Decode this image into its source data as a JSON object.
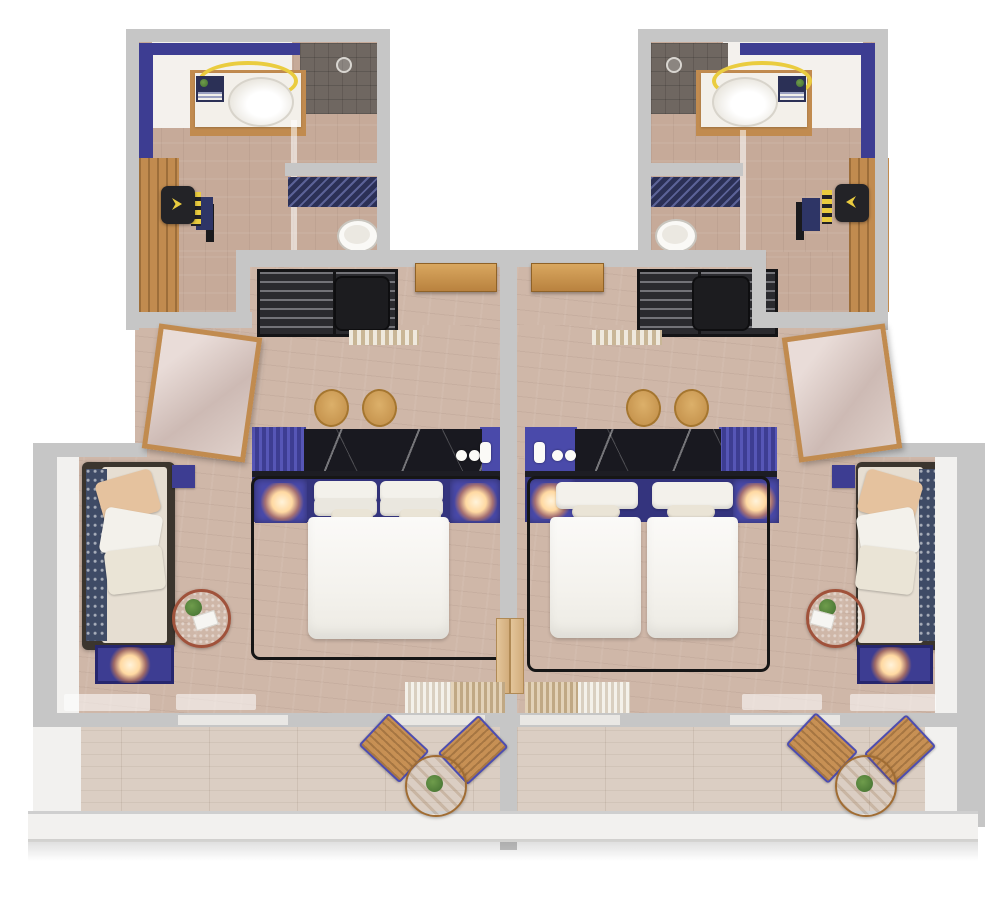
{
  "meta": {
    "kind": "3d-top-down-floor-plan-render",
    "description": "Isometric top-down 3D render of two adjoining hotel guest rooms sharing a central party wall. Each room has an en-suite bathroom with walk-in shower, vanity sink and toilet, a wardrobe and desk nook, an entry with slatted luggage racks, a bedroom with an indigo dresser console topped in black marble, nightstands with lit lamps, a lounge daybed with cushions, a round coffee table with a plant, and a private balcony with a bistro set. The left room has one double bed; the right room has two twin beds.",
    "visible_text": []
  },
  "palette": {
    "wall": "#c6c6c6",
    "wallface": "#f2f1ef",
    "floorbath": "#c6aa99",
    "floorroom": "#cfb7a8",
    "floorbalc": "#dbcec3",
    "whitezone": "#f4f1ed",
    "indigo": "#4a4aaa",
    "indigomid": "#3d3d92",
    "indigodark": "#34347e",
    "marble": "#191920",
    "seam": "#1d1d24",
    "wood": "#c18b4f",
    "doorwood": "#b9823f",
    "furndark": "#2a2a2e",
    "suitcase": "#1c1c1f",
    "sofaframe": "#3b352e",
    "linen": "#f3f1eb",
    "cream": "#eae4d6",
    "beige": "#e5c29e",
    "throwblue": "#3f4b66",
    "yellow": "#eacc3f",
    "glowcore": "#fff3da",
    "showertile": "#6f6761",
    "matnavy": "#2b3056",
    "green": "#4f7c38",
    "terracotta": "#a0523b",
    "tabletop": "#5e5e60"
  },
  "scene": {
    "units": [
      {
        "id": "left-room",
        "bed_configuration": "double",
        "bathroom": [
          "walk-in-shower",
          "shower-head",
          "vanity-counter",
          "sink",
          "led-ring-light",
          "toiletry-box",
          "glass-partition",
          "bath-mat",
          "toilet"
        ],
        "dressing": [
          "wardrobe",
          "desk",
          "desk-chair"
        ],
        "entry": [
          "luggage-rack",
          "luggage-rack",
          "suitcase",
          "doormat",
          "entrance-door"
        ],
        "bedroom": [
          "dresser-console",
          "black-marble-counter",
          "kettle",
          "cup",
          "cup",
          "stool",
          "stool",
          "headboard-console",
          "nightstand-lamp",
          "nightstand-lamp",
          "double-bed",
          "canopy-frame",
          "leaning-mirror",
          "daybed-sofa",
          "throw-blanket",
          "cushions",
          "side-table",
          "coffee-table",
          "potted-plant",
          "bench-with-lamp",
          "arc-floor-lamp",
          "curtains",
          "balcony-door"
        ],
        "balcony": [
          "bistro-table",
          "potted-plant",
          "patio-chair",
          "patio-chair"
        ]
      },
      {
        "id": "right-room",
        "bed_configuration": "twin",
        "bathroom": [
          "walk-in-shower",
          "shower-head",
          "vanity-counter",
          "sink",
          "led-ring-light",
          "toiletry-box",
          "glass-partition",
          "bath-mat",
          "toilet"
        ],
        "dressing": [
          "wardrobe",
          "desk",
          "desk-chair"
        ],
        "entry": [
          "luggage-rack",
          "luggage-rack",
          "suitcase",
          "doormat",
          "entrance-door"
        ],
        "bedroom": [
          "dresser-console",
          "black-marble-counter",
          "kettle",
          "cup",
          "cup",
          "stool",
          "stool",
          "headboard-console",
          "nightstand-lamp",
          "nightstand-lamp",
          "twin-bed",
          "twin-bed",
          "canopy-frame",
          "leaning-mirror",
          "daybed-sofa",
          "throw-blanket",
          "cushions",
          "side-table",
          "coffee-table",
          "potted-plant",
          "bench-with-lamp",
          "arc-floor-lamp",
          "curtains",
          "balcony-door"
        ],
        "balcony": [
          "bistro-table",
          "potted-plant",
          "patio-chair",
          "patio-chair"
        ]
      }
    ]
  }
}
